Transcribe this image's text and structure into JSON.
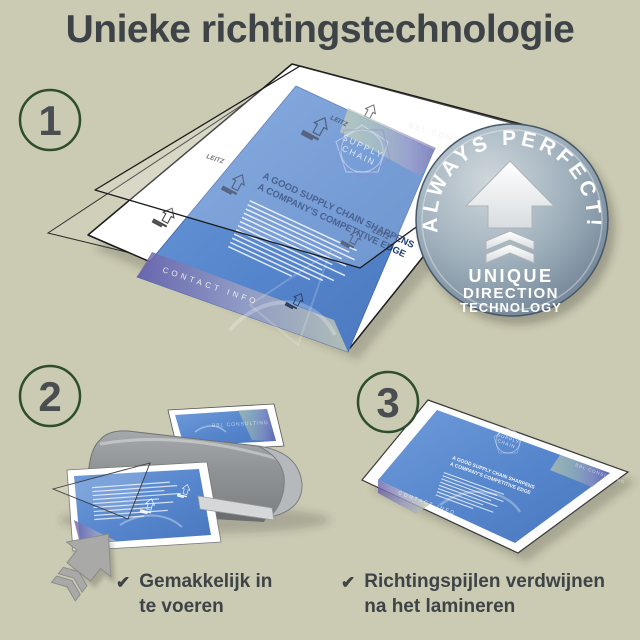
{
  "title": "Unieke richtingstechnologie",
  "steps": [
    {
      "number": "1"
    },
    {
      "number": "2"
    },
    {
      "number": "3"
    }
  ],
  "badge": {
    "curved_text": "ALWAYS PERFECT!",
    "line1": "UNIQUE",
    "line2": "DIRECTION",
    "line3": "TECHNOLOGY"
  },
  "document": {
    "brand": "BBL CONSULTING",
    "logo_line1": "SUPPLY",
    "logo_line2": "CHAIN",
    "headline_line1": "A GOOD SUPPLY CHAIN SHARPENS",
    "headline_line2": "A COMPANY'S COMPETITIVE EDGE",
    "footer": "CONTACT INFO",
    "arrow_brand": "LEITZ"
  },
  "checklist": [
    {
      "check": "✔",
      "line1": "Gemakkelijk in",
      "line2": "te voeren"
    },
    {
      "check": "✔",
      "line1": "Richtingspijlen verdwijnen",
      "line2": "na het lamineren"
    }
  ],
  "colors": {
    "background": "#cbcab2",
    "title_text": "#3d4347",
    "step_ring_green": "#2d4d2e",
    "step_number": "#4a4e51",
    "document_blue": "#5788cd",
    "headline_navy": "#1b3a75",
    "badge_face": "#8da0ae",
    "badge_rim": "#46586a",
    "badge_text": "#ffffff",
    "machine_gray": "#909395",
    "check_text": "#3e4347"
  }
}
